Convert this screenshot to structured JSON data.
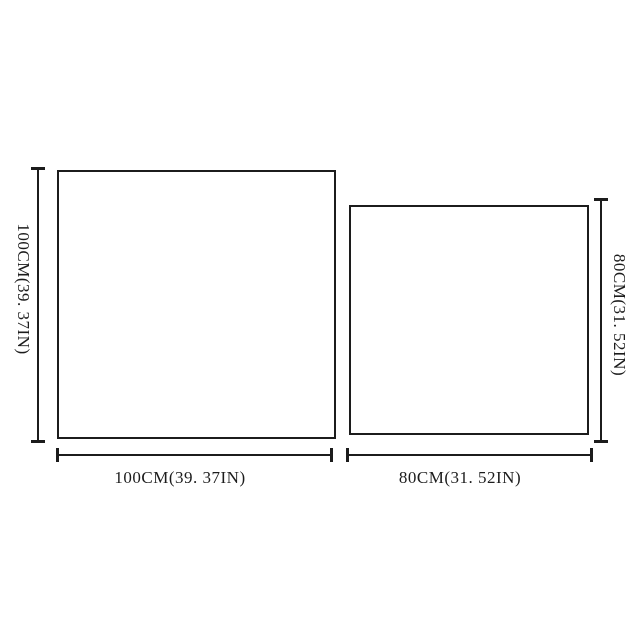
{
  "diagram": {
    "background_color": "#ffffff",
    "line_color": "#1c1c1c",
    "left_panel": {
      "height_label": "100CM(39. 37IN)",
      "width_label": "100CM(39. 37IN)"
    },
    "right_panel": {
      "height_label": "80CM(31. 52IN)",
      "width_label": "80CM(31. 52IN)"
    }
  }
}
